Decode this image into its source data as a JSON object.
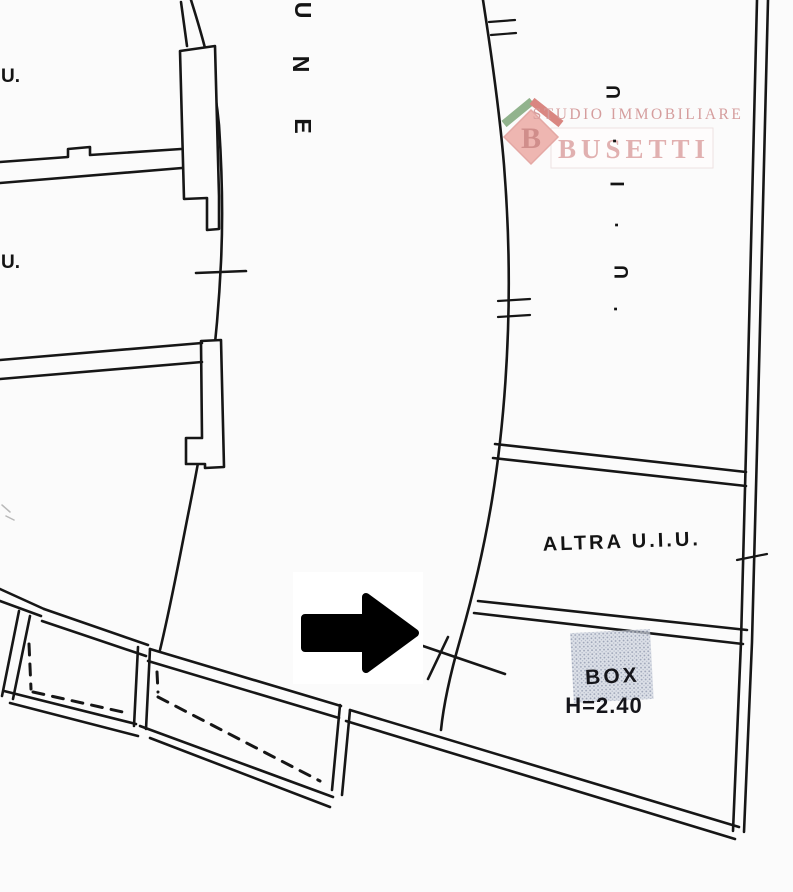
{
  "watermark": {
    "line1": "STUDIO IMMOBILIARE",
    "line2": "BUSETTI",
    "logo_letter": "B"
  },
  "plan": {
    "label_altra": "ALTRA U.I.U.",
    "label_box": "BOX",
    "label_box_height": "H=2.40",
    "street_letters": [
      "U",
      "N",
      "E"
    ],
    "right_column_letters": [
      "U",
      ".",
      "I",
      ".",
      "U",
      "."
    ],
    "left_edge_fragments": [
      "U.",
      "U."
    ]
  },
  "colors": {
    "line": "#161616",
    "watermark_text": "#cf8d8d",
    "watermark_name": "#dda4a3",
    "logo_diamond": "#ecaaa5",
    "logo_diamond_edge": "#e09a95",
    "logo_letter": "#c97b78",
    "logo_roof_left": "#7fa77a",
    "logo_roof_right": "#d4726c",
    "stipple_base": "#ccd2dd",
    "arrow": "#000000"
  }
}
